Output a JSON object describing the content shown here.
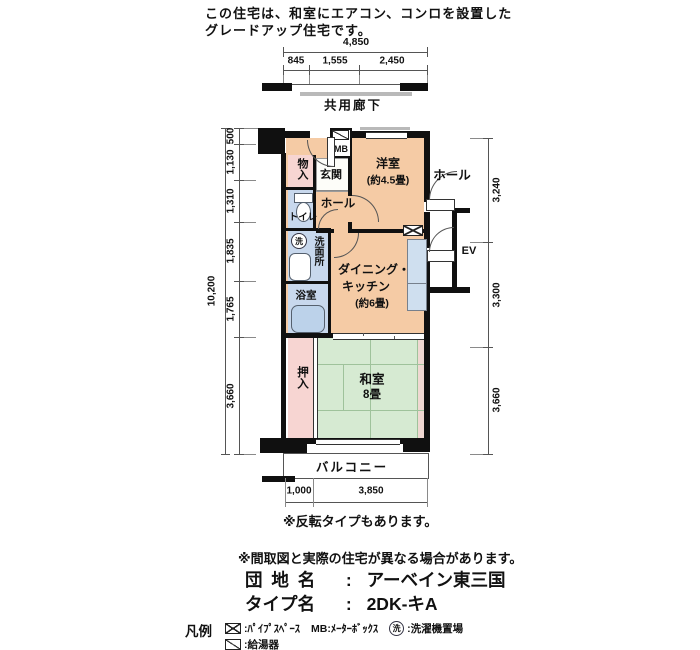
{
  "header": {
    "line1": "この住宅は、和室にエアコン、コンロを設置した",
    "line2": "グレードアップ住宅です。"
  },
  "plan": {
    "corridor": "共用廊下",
    "balcony": "バルコニー",
    "rooms": {
      "western": {
        "name": "洋室",
        "size": "(約4.5畳)"
      },
      "dk": {
        "name1": "ダイニング・",
        "name2": "キッチン",
        "size": "(約6畳)"
      },
      "japanese": {
        "name": "和室",
        "size": "8畳"
      },
      "oshiire": "押入",
      "monoire": "物入",
      "genkan": "玄関",
      "hall": "ホール",
      "outer_hall": "ホール",
      "toilet": "トイレ",
      "washroom": "洗面所",
      "washer": "洗",
      "bath": "浴室",
      "mb": "MB",
      "ev": "EV"
    },
    "colors": {
      "room_peach": "#f5cba5",
      "tatami_green": "#d6ead2",
      "closet_pink": "#f7d5d2",
      "wet_blue": "#c8d8ed"
    }
  },
  "dims": {
    "top_total": "4,850",
    "top": [
      "845",
      "1,555",
      "2,450"
    ],
    "left_total": "10,200",
    "left": [
      "500",
      "1,130",
      "1,310",
      "1,835",
      "1,765",
      "3,660"
    ],
    "right": [
      "3,240",
      "3,300",
      "3,660"
    ],
    "bottom": [
      "1,000",
      "3,850"
    ]
  },
  "notes": {
    "reverse": "※反転タイプもあります。",
    "disclaimer": "※間取図と実際の住宅が異なる場合があります。"
  },
  "info": {
    "estate_label": "団 地 名",
    "estate_colon": ":",
    "estate_value": "アーベイン東三国",
    "type_label": "タイプ名",
    "type_colon": ":",
    "type_value": "2DK-キA"
  },
  "legend": {
    "title": "凡例",
    "pipe_label": ":ﾊﾟｲﾌﾟｽﾍﾟｰｽ",
    "mb_label": "MB:ﾒｰﾀｰﾎﾞｯｸｽ",
    "washer_symbol": "洗",
    "washer_label": ":洗濯機置場",
    "heater_label": ":給湯器"
  }
}
